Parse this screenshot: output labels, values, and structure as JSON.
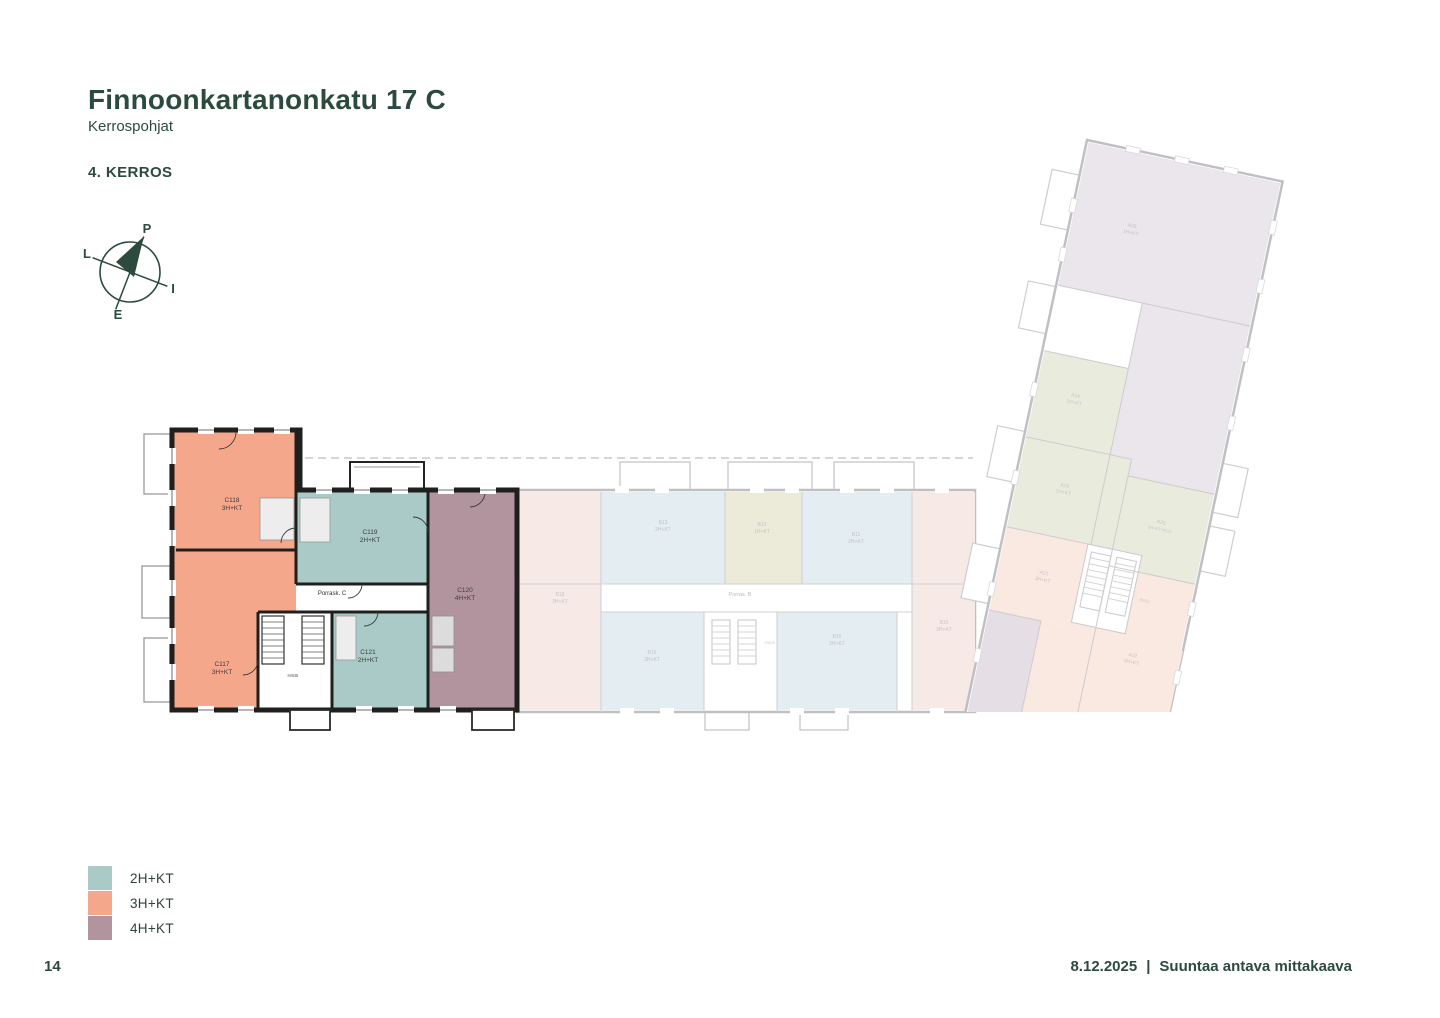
{
  "page": {
    "title": "Finnoonkartanonkatu 17 C",
    "subtitle": "Kerrospohjat",
    "floor_label": "4. KERROS",
    "page_number": "14",
    "footer_date": "8.12.2025",
    "footer_separator": "|",
    "footer_note": "Suuntaa antava mittakaava"
  },
  "compass": {
    "north_label": "P",
    "east_label": "I",
    "south_label": "E",
    "west_label": "L"
  },
  "colors": {
    "accent": "#2c4a3e",
    "wall": "#1f1f1d",
    "apartment_2hkt": "#a9cac6",
    "apartment_3hkt": "#f5a78c",
    "apartment_4hkt": "#b2949e"
  },
  "legend": {
    "items": [
      {
        "label": "2H+KT",
        "color": "#a9cac6"
      },
      {
        "label": "3H+KT",
        "color": "#f5a78c"
      },
      {
        "label": "4H+KT",
        "color": "#b2949e"
      }
    ]
  },
  "floorplan": {
    "building_c": {
      "stairwell_label": "Porrask. C",
      "elevator_label": "HISSI",
      "apartments": [
        {
          "id": "C118",
          "type": "3H+KT"
        },
        {
          "id": "C117",
          "type": "3H+KT"
        },
        {
          "id": "C119",
          "type": "2H+KT"
        },
        {
          "id": "C121",
          "type": "2H+KT"
        },
        {
          "id": "C120",
          "type": "4H+KT"
        }
      ]
    },
    "building_b": {
      "stairwell_label": "Porras. B",
      "elevator_label": "HISSI",
      "apartments": [
        {
          "id": "B18",
          "type": "3H+KT"
        },
        {
          "id": "B13",
          "type": "2H+KT"
        },
        {
          "id": "B12",
          "type": "1H+KT"
        },
        {
          "id": "B11",
          "type": "2H+KT"
        },
        {
          "id": "B10",
          "type": "3H+KT"
        },
        {
          "id": "B16",
          "type": "2H+KT"
        },
        {
          "id": "B15",
          "type": "2H+KT"
        }
      ]
    },
    "building_a": {
      "elevator_label": "HISSI",
      "apartments": [
        {
          "id": "A26",
          "type": "1H+KT"
        },
        {
          "id": "A24",
          "type": "1H+KT"
        },
        {
          "id": "A23",
          "type": "1H+KT"
        },
        {
          "id": "A25",
          "type": "1H+KT+KLH"
        },
        {
          "id": "A21",
          "type": "3H+KT"
        },
        {
          "id": "A22",
          "type": "3H+KT"
        }
      ]
    }
  }
}
